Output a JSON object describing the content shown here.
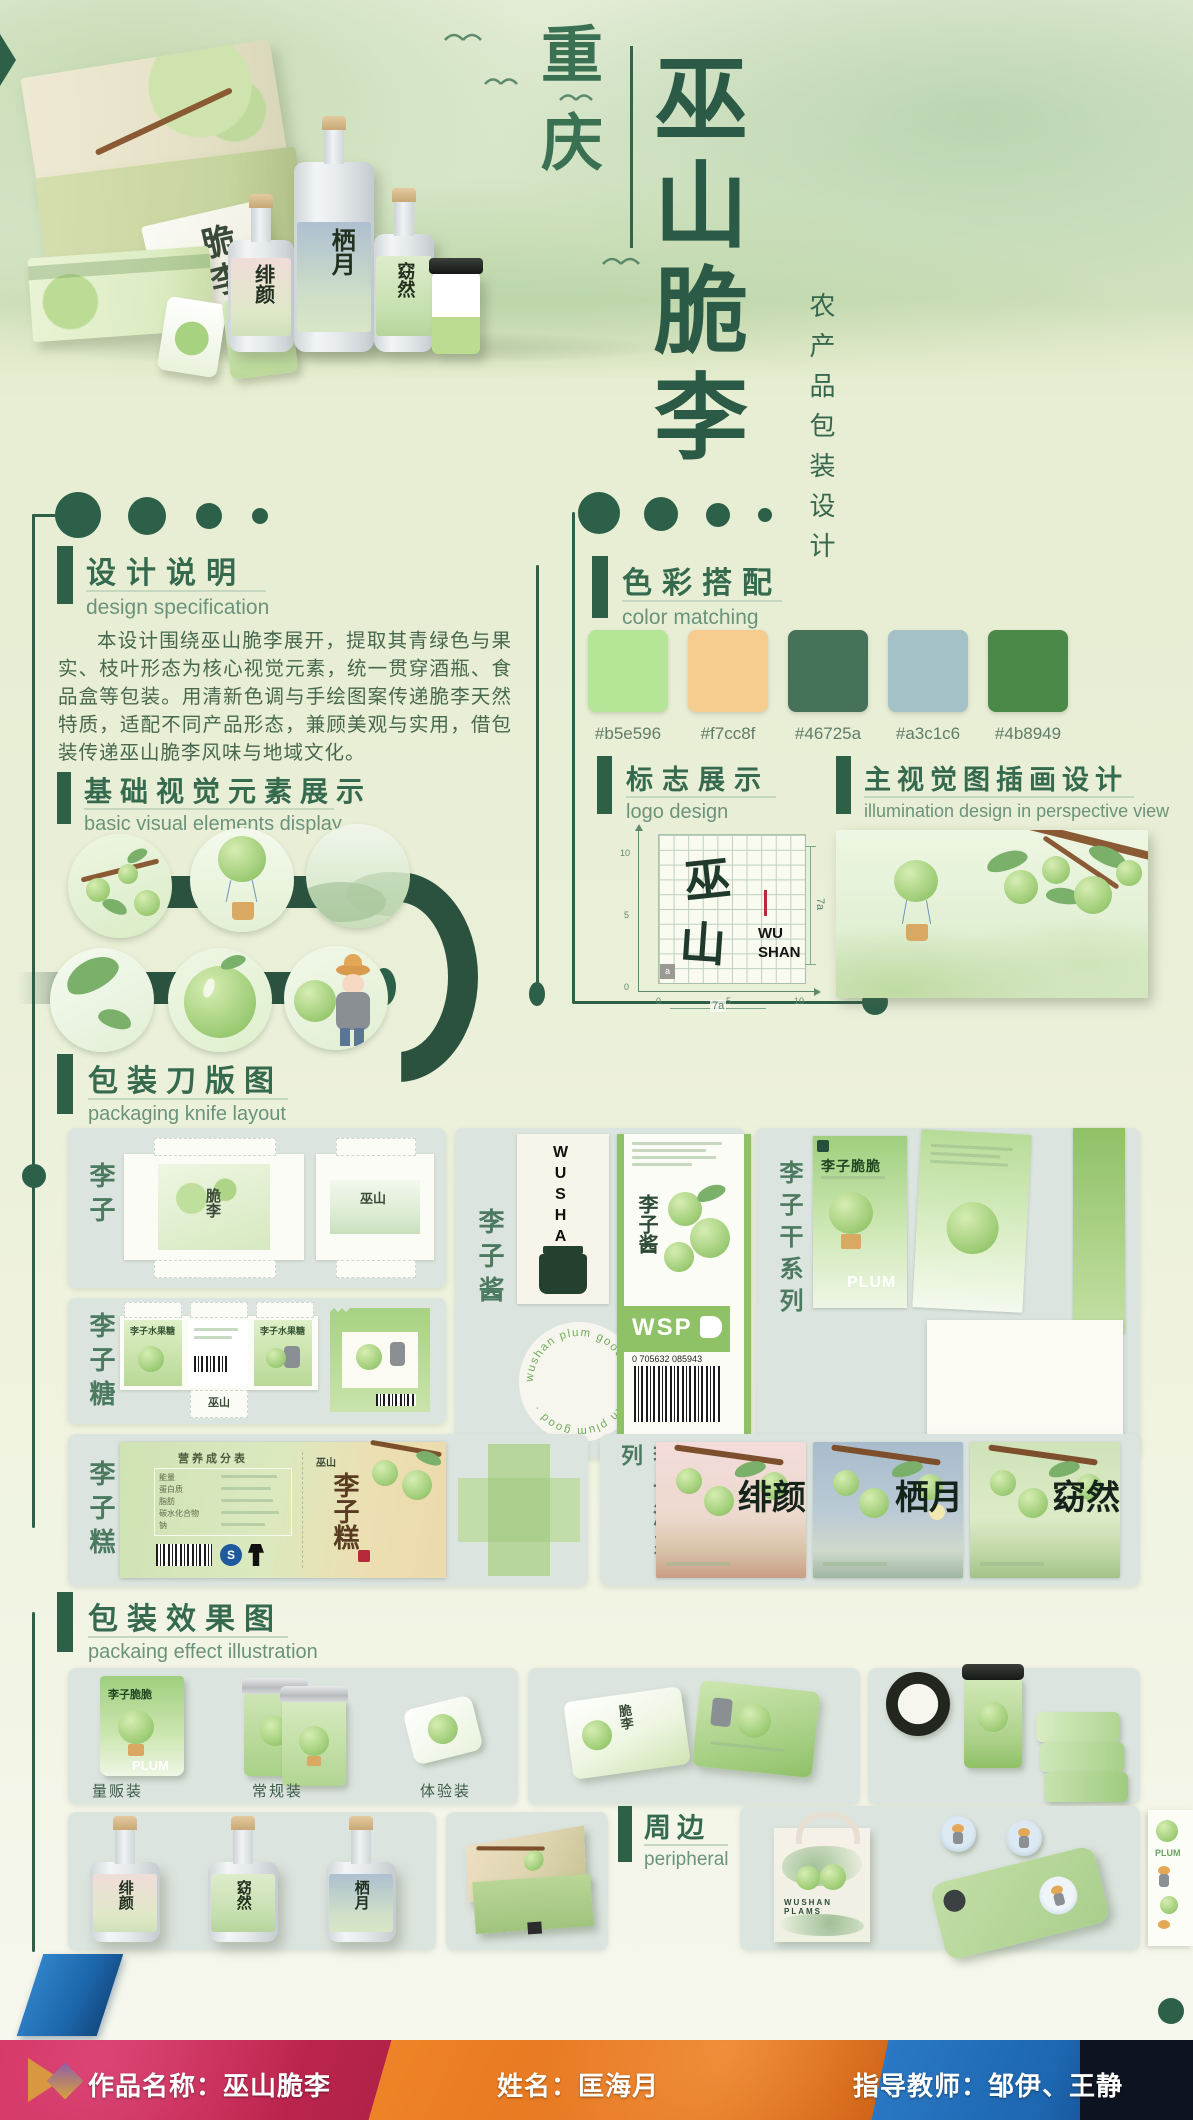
{
  "poster": {
    "region_vertical": "重庆",
    "main_title_vertical": "巫山脆李",
    "subtitle_vertical": "农产品包装设计"
  },
  "hero": {
    "white_box_chars": "脆李",
    "bottle_names": [
      "绯颜",
      "栖月",
      "窈然"
    ]
  },
  "sections": {
    "design_spec": {
      "title": "设计说明",
      "subtitle": "design specification",
      "body": "本设计围绕巫山脆李展开，提取其青绿色与果实、枝叶形态为核心视觉元素，统一贯穿酒瓶、食品盒等包装。用清新色调与手绘图案传递脆李天然特质，适配不同产品形态，兼顾美观与实用，借包装传递巫山脆李风味与地域文化。"
    },
    "basic_elements": {
      "title": "基础视觉元素展示",
      "subtitle": "basic visual elements display"
    },
    "color_matching": {
      "title": "色彩搭配",
      "subtitle": "color matching",
      "swatches": [
        {
          "hex": "#b5e596"
        },
        {
          "hex": "#f7cc8f"
        },
        {
          "hex": "#46725a"
        },
        {
          "hex": "#a3c1c6"
        },
        {
          "hex": "#4b8949"
        }
      ]
    },
    "logo_design": {
      "title": "标志展示",
      "subtitle": "logo design",
      "logo_char_top": "巫",
      "logo_char_bottom": "山",
      "logo_latin_top": "WU",
      "logo_latin_bottom": "SHAN",
      "dim_right": "7a",
      "dim_bottom": "7a",
      "unit_cell": "a",
      "ticks": [
        "0",
        "5",
        "10"
      ]
    },
    "main_visual": {
      "title": "主视觉图插画设计",
      "subtitle": "illumination design in perspective view"
    },
    "knife_layout": {
      "title": "包装刀版图",
      "subtitle": "packaging knife layout",
      "plum": {
        "label": "李子",
        "art_chars": "脆李",
        "brand_mark": "巫山"
      },
      "jam": {
        "label": "李子酱",
        "brand_vertical": "WUSHAN",
        "stamp_text": "wushan plum good · wushan plum good ·",
        "wsp": "WSP",
        "barcode_digits": "0 705632 085943"
      },
      "dried": {
        "label": "李子干系列",
        "pouch_title": "李子脆脆",
        "plum_en": "PLUM"
      },
      "candy": {
        "label": "李子糖",
        "box_title": "李子水果糖",
        "brand_mark": "巫山"
      },
      "cake": {
        "label": "李子糕",
        "nutrition_title": "营养成分表",
        "nutrition_rows": [
          "能量",
          "蛋白质",
          "脂肪",
          "碳水化合物",
          "钠"
        ],
        "product_calligraphy": "李子糕",
        "brand_mark": "巫山"
      },
      "wine": {
        "label": "李子酒系列",
        "names": [
          "绯颜",
          "栖月",
          "窈然"
        ]
      }
    },
    "effect": {
      "title": "包装效果图",
      "subtitle": "packaing effect illustration",
      "pack_labels": [
        "量贩装",
        "常规装",
        "体验装"
      ],
      "pouch_title": "李子脆脆",
      "pouch_en": "PLUM",
      "bottle_names": [
        "绯颜",
        "窈然",
        "栖月"
      ]
    },
    "peripheral": {
      "title": "周边",
      "subtitle": "peripheral",
      "tote_text": "WUSHAN PLAMS",
      "sticker_text": "PLUM"
    }
  },
  "footer": {
    "work_label": "作品名称：巫山脆李",
    "name_label": "姓名：匡海月",
    "teacher_label": "指导教师：邹伊、王静"
  },
  "theme": {
    "accent_dark_green": "#2e6047",
    "heading_green": "#356a4e",
    "panel_grey_green": "#dce4df",
    "footer_red": "#c22750",
    "footer_orange": "#e0711c",
    "footer_blue": "#1d66b0",
    "footer_navy": "#0e1322"
  }
}
